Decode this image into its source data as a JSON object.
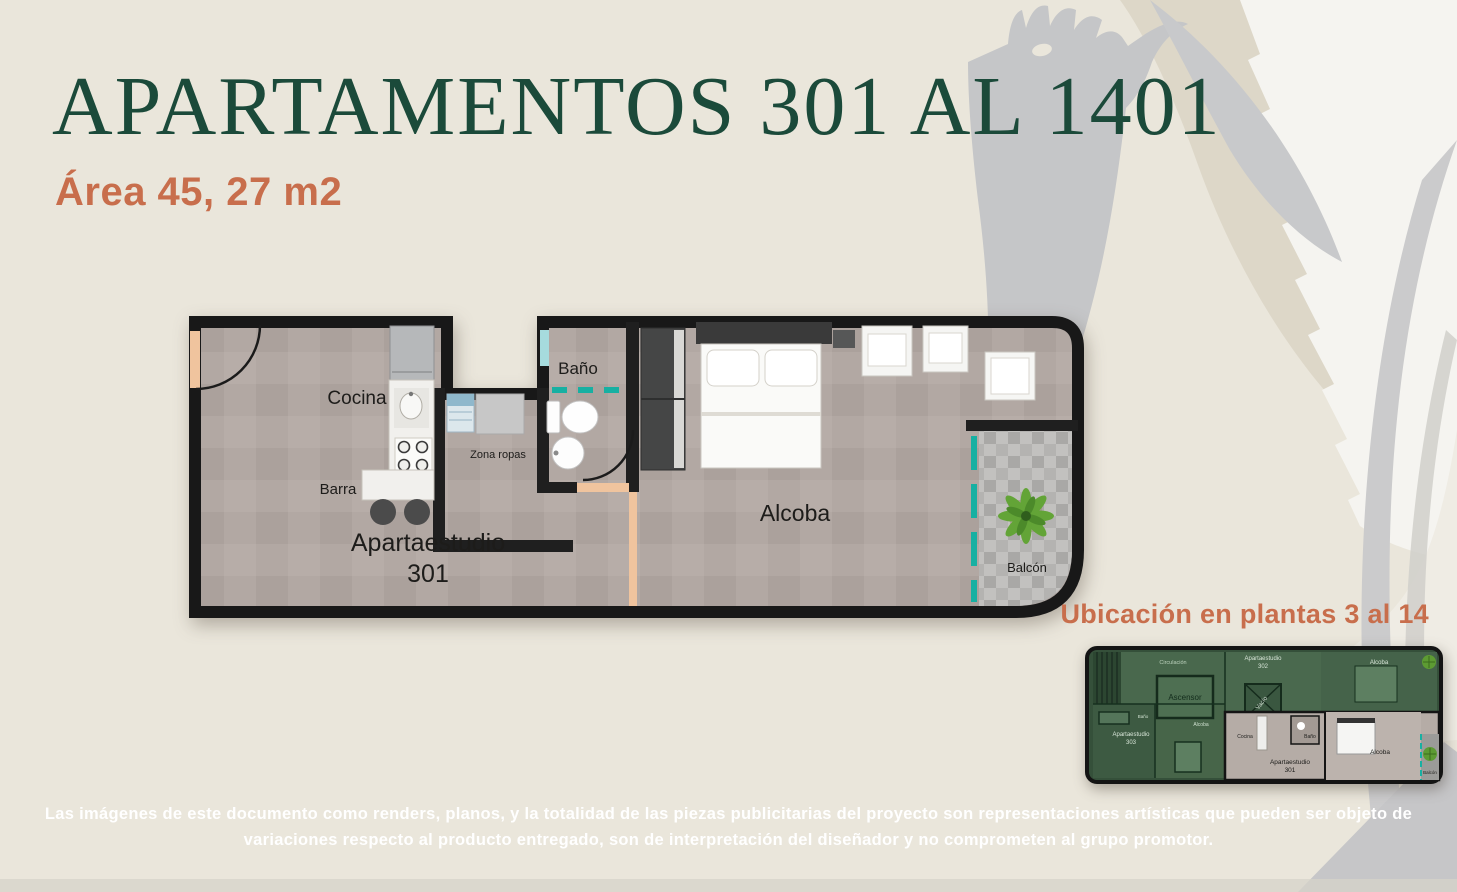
{
  "colors": {
    "bg": "#eae6db",
    "brand_green": "#1b4a3a",
    "brand_orange": "#c86e4c",
    "wall": "#181818",
    "teal": "#17b0a2",
    "peach": "#f0c49e",
    "disclaimer": "#ffffff"
  },
  "header": {
    "title": "APARTAMENTOS 301 AL 1401",
    "subtitle": "Área 45, 27 m2"
  },
  "floor_plan": {
    "labels": {
      "cocina": "Cocina",
      "barra": "Barra",
      "zona_ropas": "Zona ropas",
      "bano": "Baño",
      "unit_name": "Apartaestudio",
      "unit_number": "301",
      "alcoba": "Alcoba",
      "balcon": "Balcón"
    }
  },
  "location": {
    "heading": "Ubicación en plantas 3 al 14",
    "thumb_labels": {
      "circulacion": "Circulación",
      "ascensor": "Ascensor",
      "apt_top_name": "Apartaestudio",
      "apt_top_number": "302",
      "alcoba_top_right": "Alcoba",
      "vacio": "Vacío",
      "apt_left_name": "Apartaestudio",
      "apt_left_number": "303",
      "alcoba_left": "Alcoba",
      "bano_left": "Baño",
      "cocina": "Cocina",
      "bano": "Baño",
      "apt_name": "Apartaestudio",
      "apt_number": "301",
      "alcoba": "Alcoba",
      "balcon": "Balcón"
    }
  },
  "disclaimer": {
    "line1": "Las imágenes de este documento como renders, planos, y la totalidad de las piezas publicitarias del proyecto son representaciones artísticas que pueden ser objeto de",
    "line2": "variaciones respecto al producto entregado, son de interpretación del diseñador y no comprometen al grupo promotor."
  }
}
